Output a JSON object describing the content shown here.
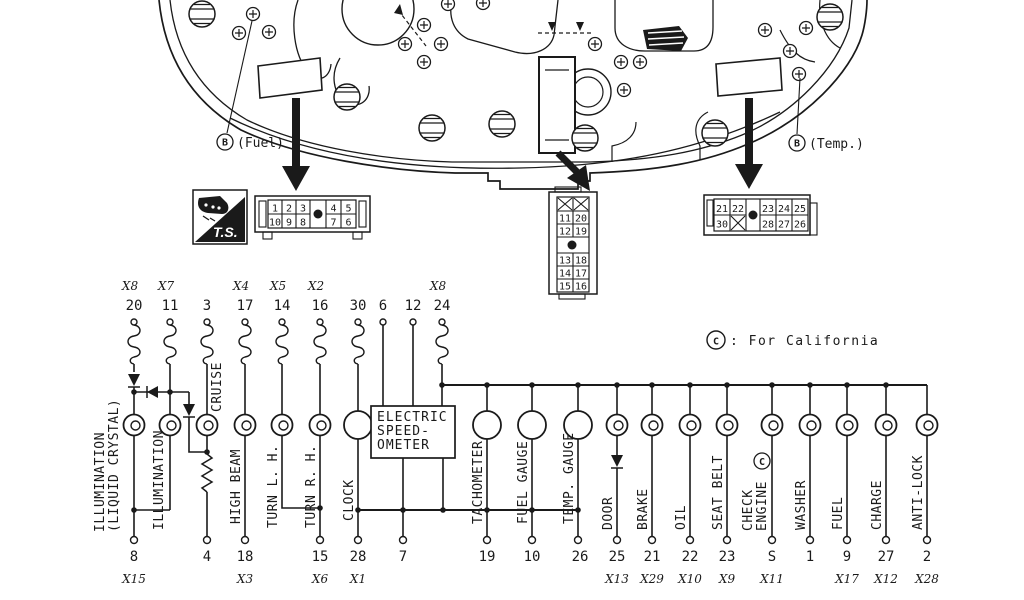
{
  "cluster": {
    "fuel_tag": {
      "terminal": "B",
      "label": "(Fuel)"
    },
    "temp_tag": {
      "terminal": "B",
      "label": "(Temp.)"
    },
    "ts_badge": "T.S."
  },
  "connectors": {
    "a": {
      "row1": [
        "1",
        "2",
        "3",
        "4",
        "5"
      ],
      "row2": [
        "10",
        "9",
        "8",
        "7",
        "6"
      ]
    },
    "b": {
      "crossed": [
        "X",
        "X"
      ],
      "rows": [
        [
          "11",
          "20"
        ],
        [
          "12",
          "19"
        ],
        [
          "13",
          "18"
        ],
        [
          "14",
          "17"
        ],
        [
          "15",
          "16"
        ]
      ]
    },
    "c": {
      "row1": [
        "21",
        "22",
        "23",
        "24",
        "25"
      ],
      "row2": [
        "30",
        "X",
        "28",
        "27",
        "26"
      ]
    }
  },
  "note": {
    "symbol": "C",
    "text": ": For California"
  },
  "speedometer": {
    "line1": "ELECTRIC",
    "line2": "SPEED-",
    "line3": "OMETER"
  },
  "top_pins": {
    "illum_lcd": {
      "pin": "20",
      "conn": "X8"
    },
    "illum": {
      "pin": "11",
      "conn": "X7"
    },
    "cruise": {
      "pin": "3"
    },
    "high_beam": {
      "pin": "17",
      "conn": "X4"
    },
    "turn_lh": {
      "pin": "14",
      "conn": "X5"
    },
    "turn_rh": {
      "pin": "16",
      "conn": "X2"
    },
    "clock": {
      "pin": "30"
    },
    "speedo_a": {
      "pin": "6"
    },
    "speedo_b": {
      "pin": "12"
    },
    "feed": {
      "pin": "24",
      "conn": "X8"
    }
  },
  "bottom_pins": {
    "illum_lcd": {
      "pin": "8",
      "conn": "X15"
    },
    "cruise": {
      "pin": "4"
    },
    "high_beam": {
      "pin": "18",
      "conn": "X3"
    },
    "turn": {
      "pin": "15",
      "conn": "X6"
    },
    "clock": {
      "pin": "28",
      "conn": "X1"
    },
    "speedo": {
      "pin": "7"
    },
    "tachometer": {
      "pin": "19"
    },
    "fuel_gauge": {
      "pin": "10"
    },
    "temp_gauge": {
      "pin": "26"
    },
    "door": {
      "pin": "25",
      "conn": "X13"
    },
    "brake": {
      "pin": "21",
      "conn": "X29"
    },
    "oil": {
      "pin": "22",
      "conn": "X10"
    },
    "seat_belt": {
      "pin": "23",
      "conn": "X9"
    },
    "check_engine": {
      "pin": "S",
      "conn": "X11"
    },
    "washer": {
      "pin": "1"
    },
    "fuel_warn": {
      "pin": "9",
      "conn": "X17"
    },
    "charge": {
      "pin": "27",
      "conn": "X12"
    },
    "anti_lock": {
      "pin": "2",
      "conn": "X28"
    }
  },
  "labels": {
    "illum_line1": "ILLUMINATION",
    "illum_line2": "(LIQUID CRYSTAL)",
    "illum": "ILLUMINATION",
    "cruise": "CRUISE",
    "high_beam": "HIGH BEAM",
    "turn_lh": "TURN L. H.",
    "turn_rh": "TURN R. H.",
    "clock": "CLOCK",
    "tachometer": "TACHOMETER",
    "fuel_gauge": "FUEL GAUGE",
    "temp_gauge": "TEMP. GAUGE",
    "door": "DOOR",
    "brake": "BRAKE",
    "oil": "OIL",
    "seat_belt": "SEAT BELT",
    "check_engine_line1": "CHECK",
    "check_engine_line2": "ENGINE",
    "check_engine_marker": "C",
    "washer": "WASHER",
    "fuel_warn": "FUEL",
    "charge": "CHARGE",
    "anti_lock": "ANTI-LOCK"
  }
}
